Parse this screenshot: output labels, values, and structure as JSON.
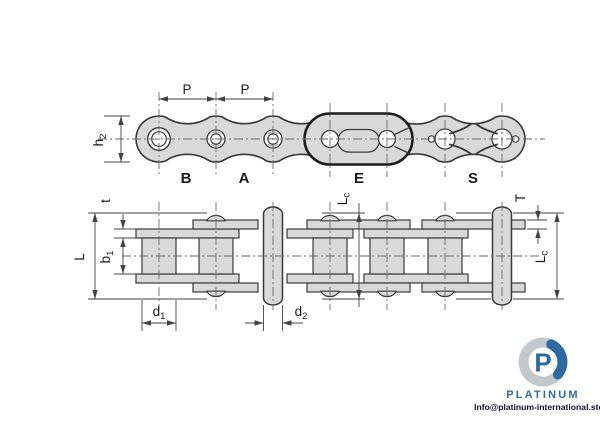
{
  "colors": {
    "chain_fill": "#d9d9d9",
    "line": "#3a3a3a",
    "outline_heavy": "#1c1c1c",
    "dim_line": "#444444",
    "centerline": "#6a6a6a",
    "shade": "#c9cdd1",
    "text": "#1a1a1a",
    "logo_blue": "#2d6aa0",
    "logo_silver": "#c3c8cd",
    "info_text": "#10102a"
  },
  "top_view": {
    "pitch": "P",
    "height": {
      "base": "h",
      "sub": "2"
    },
    "links": [
      "B",
      "A",
      "E",
      "S"
    ]
  },
  "bottom_view": {
    "t": "t",
    "b1": {
      "base": "b",
      "sub": "1"
    },
    "L": "L",
    "d1": {
      "base": "d",
      "sub": "1"
    },
    "d2": {
      "base": "d",
      "sub": "2"
    },
    "lc_mid": {
      "base": "L",
      "sub": "c"
    },
    "T": "T",
    "lc_right": {
      "base": "L",
      "sub": "c"
    }
  },
  "logo": {
    "brand": "PLATINUM",
    "email": "Info@platinum-international.store"
  }
}
